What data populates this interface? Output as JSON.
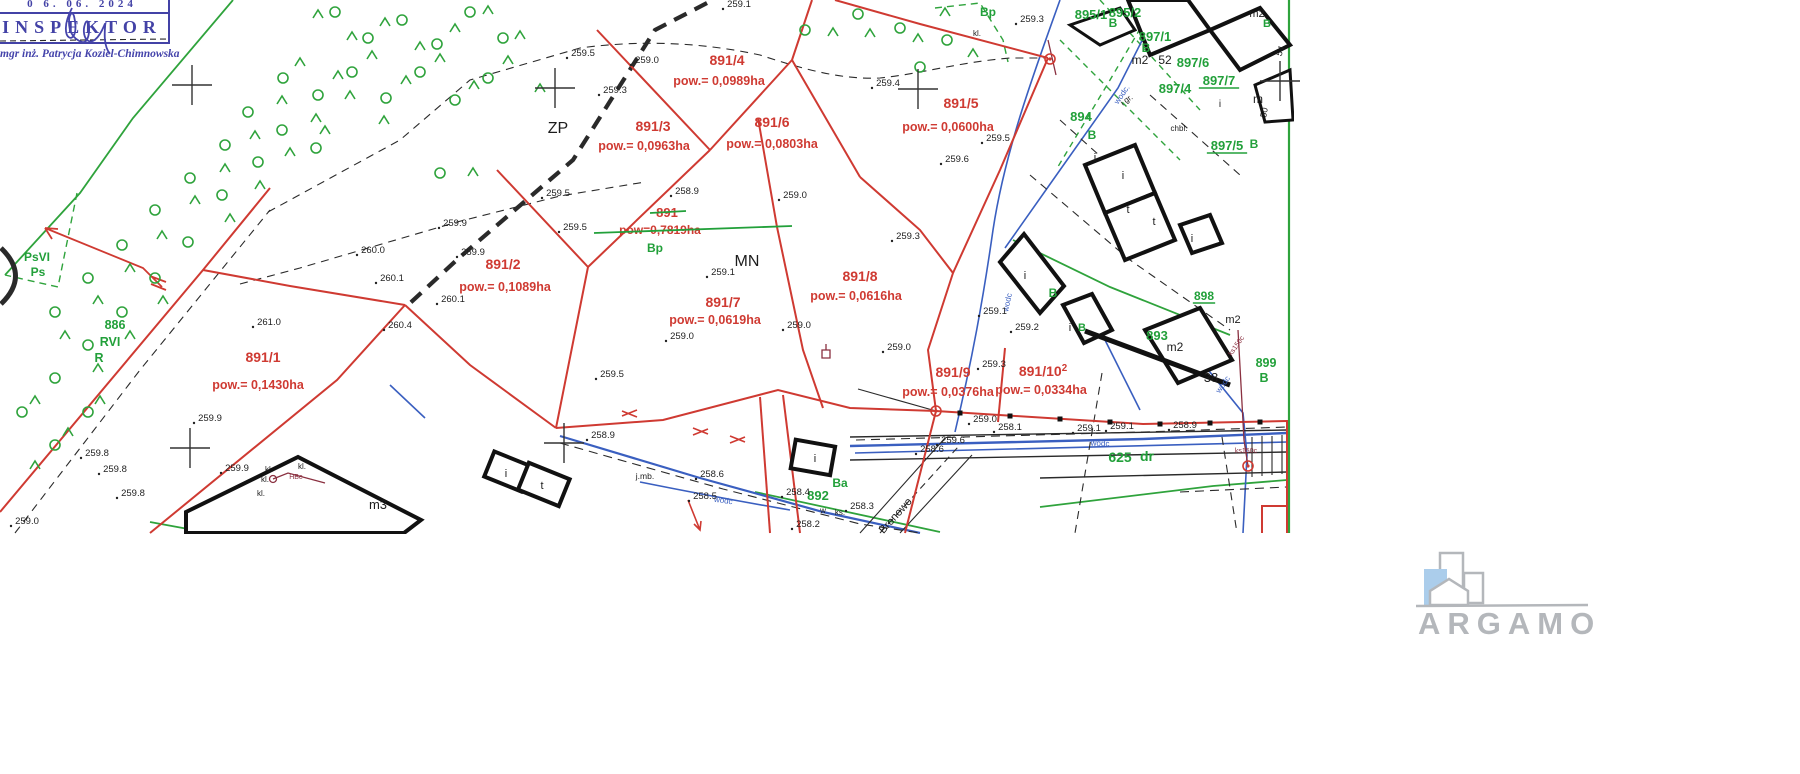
{
  "stamp": {
    "date": "0 6. 06. 2024",
    "title": "INSPEKTOR",
    "signer": "mgr inż. Patrycja Koziel-Chimnowska"
  },
  "logo": {
    "text": "ARGAMO"
  },
  "map": {
    "colors": {
      "red": "#cf3a32",
      "green": "#22a03a",
      "blue": "#3a5fc0",
      "maroon": "#8a3040",
      "black": "#1c1c1c"
    },
    "labels": [
      {
        "t": "891/1",
        "x": 263,
        "y": 362,
        "c": "red",
        "s": 14
      },
      {
        "t": "pow.= 0,1430ha",
        "x": 258,
        "y": 389,
        "c": "red",
        "s": 12.5
      },
      {
        "t": "891/2",
        "x": 503,
        "y": 269,
        "c": "red",
        "s": 14
      },
      {
        "t": "pow.= 0,1089ha",
        "x": 505,
        "y": 291,
        "c": "red",
        "s": 12.5
      },
      {
        "t": "891/3",
        "x": 653,
        "y": 131,
        "c": "red",
        "s": 14
      },
      {
        "t": "pow.= 0,0963ha",
        "x": 644,
        "y": 150,
        "c": "red",
        "s": 12.5
      },
      {
        "t": "891/4",
        "x": 727,
        "y": 65,
        "c": "red",
        "s": 14
      },
      {
        "t": "pow.= 0,0989ha",
        "x": 719,
        "y": 85,
        "c": "red",
        "s": 12.5
      },
      {
        "t": "891/5",
        "x": 961,
        "y": 108,
        "c": "red",
        "s": 14
      },
      {
        "t": "pow.= 0,0600ha",
        "x": 948,
        "y": 131,
        "c": "red",
        "s": 12.5
      },
      {
        "t": "891/6",
        "x": 772,
        "y": 127,
        "c": "red",
        "s": 14
      },
      {
        "t": "pow.= 0,0803ha",
        "x": 772,
        "y": 148,
        "c": "red",
        "s": 12.5
      },
      {
        "t": "891/7",
        "x": 723,
        "y": 307,
        "c": "red",
        "s": 14
      },
      {
        "t": "pow.= 0,0619ha",
        "x": 715,
        "y": 324,
        "c": "red",
        "s": 12.5
      },
      {
        "t": "891/8",
        "x": 860,
        "y": 281,
        "c": "red",
        "s": 14
      },
      {
        "t": "pow.= 0,0616ha",
        "x": 856,
        "y": 300,
        "c": "red",
        "s": 12.5
      },
      {
        "t": "891/9",
        "x": 953,
        "y": 377,
        "c": "red",
        "s": 14
      },
      {
        "t": "pow.= 0,0376ha",
        "x": 948,
        "y": 396,
        "c": "red",
        "s": 12.5
      },
      {
        "t": "891/10",
        "x": 1043,
        "y": 376,
        "c": "red",
        "s": 14,
        "sup": "2"
      },
      {
        "t": "pow.= 0,0334ha",
        "x": 1041,
        "y": 394,
        "c": "red",
        "s": 12.5
      },
      {
        "t": "891",
        "x": 667,
        "y": 217,
        "c": "red",
        "s": 13,
        "strike": [
          650,
          213,
          686,
          211
        ]
      },
      {
        "t": "pow=0,7819ha",
        "x": 660,
        "y": 234,
        "c": "red",
        "s": 12,
        "strike": [
          594,
          233,
          792,
          226
        ]
      },
      {
        "t": "PsVI",
        "x": 37,
        "y": 261,
        "c": "green",
        "s": 12
      },
      {
        "t": "Ps",
        "x": 38,
        "y": 276,
        "c": "green",
        "s": 12
      },
      {
        "t": "886",
        "x": 115,
        "y": 329,
        "c": "green",
        "s": 12.5
      },
      {
        "t": "RVI",
        "x": 110,
        "y": 346,
        "c": "green",
        "s": 12.5
      },
      {
        "t": "R",
        "x": 99,
        "y": 362,
        "c": "green",
        "s": 12.5
      },
      {
        "t": "Bp",
        "x": 655,
        "y": 252,
        "c": "green",
        "s": 12
      },
      {
        "t": "Bp",
        "x": 988,
        "y": 16,
        "c": "green",
        "s": 12
      },
      {
        "t": "892",
        "x": 818,
        "y": 500,
        "c": "green",
        "s": 13
      },
      {
        "t": "Ba",
        "x": 840,
        "y": 487,
        "c": "green",
        "s": 12
      },
      {
        "t": "893",
        "x": 1157,
        "y": 340,
        "c": "green",
        "s": 13
      },
      {
        "t": "894",
        "x": 1081,
        "y": 121,
        "c": "green",
        "s": 13
      },
      {
        "t": "B",
        "x": 1092,
        "y": 139,
        "c": "green",
        "s": 12
      },
      {
        "t": "895/1",
        "x": 1091,
        "y": 19,
        "c": "green",
        "s": 13
      },
      {
        "t": "895/2",
        "x": 1125,
        "y": 17,
        "c": "green",
        "s": 13
      },
      {
        "t": "B",
        "x": 1113,
        "y": 27,
        "c": "green",
        "s": 12
      },
      {
        "t": "897/1",
        "x": 1155,
        "y": 41,
        "c": "green",
        "s": 13
      },
      {
        "t": "B",
        "x": 1146,
        "y": 52,
        "c": "green",
        "s": 12
      },
      {
        "t": "897/4",
        "x": 1175,
        "y": 93,
        "c": "green",
        "s": 13
      },
      {
        "t": "897/5",
        "x": 1227,
        "y": 150,
        "c": "green",
        "s": 13,
        "u": 1
      },
      {
        "t": "B",
        "x": 1254,
        "y": 148,
        "c": "green",
        "s": 12
      },
      {
        "t": "897/6",
        "x": 1193,
        "y": 67,
        "c": "green",
        "s": 13
      },
      {
        "t": "897/7",
        "x": 1219,
        "y": 85,
        "c": "green",
        "s": 13,
        "u": 1
      },
      {
        "t": "898",
        "x": 1204,
        "y": 300,
        "c": "green",
        "s": 12,
        "u": 1
      },
      {
        "t": "B",
        "x": 1053,
        "y": 297,
        "c": "green",
        "s": 12
      },
      {
        "t": "B",
        "x": 1082,
        "y": 331,
        "c": "green",
        "s": 11
      },
      {
        "t": "899",
        "x": 1266,
        "y": 367,
        "c": "green",
        "s": 12.5
      },
      {
        "t": "B",
        "x": 1264,
        "y": 382,
        "c": "green",
        "s": 12.5
      },
      {
        "t": "B",
        "x": 1267,
        "y": 27,
        "c": "green",
        "s": 11
      },
      {
        "t": "625",
        "x": 1120,
        "y": 462,
        "c": "green",
        "s": 14
      },
      {
        "t": "dr",
        "x": 1147,
        "y": 461,
        "c": "green",
        "s": 14
      },
      {
        "t": "ZP",
        "x": 558,
        "y": 133,
        "c": "black",
        "s": 16
      },
      {
        "t": "MN",
        "x": 747,
        "y": 266,
        "c": "black",
        "s": 16
      },
      {
        "t": "m3",
        "x": 378,
        "y": 509,
        "c": "black",
        "s": 13
      },
      {
        "t": "m2",
        "x": 1140,
        "y": 64,
        "c": "black",
        "s": 12
      },
      {
        "t": "52",
        "x": 1165,
        "y": 64,
        "c": "black",
        "s": 12
      },
      {
        "t": "m2",
        "x": 1175,
        "y": 351,
        "c": "black",
        "s": 12
      },
      {
        "t": "m2",
        "x": 1233,
        "y": 323,
        "c": "black",
        "s": 11
      },
      {
        "t": "m2",
        "x": 1257,
        "y": 17,
        "c": "black",
        "s": 11
      },
      {
        "t": "m",
        "x": 1258,
        "y": 103,
        "c": "black",
        "s": 12
      },
      {
        "t": "38",
        "x": 1211,
        "y": 382,
        "c": "black",
        "s": 13
      },
      {
        "t": "i",
        "x": 506,
        "y": 477,
        "c": "black",
        "s": 11
      },
      {
        "t": "t",
        "x": 542,
        "y": 489,
        "c": "black",
        "s": 11
      },
      {
        "t": "i",
        "x": 815,
        "y": 462,
        "c": "black",
        "s": 11
      },
      {
        "t": "i",
        "x": 1025,
        "y": 279,
        "c": "black",
        "s": 11
      },
      {
        "t": "i",
        "x": 1070,
        "y": 331,
        "c": "black",
        "s": 11
      },
      {
        "t": "i",
        "x": 1095,
        "y": 161,
        "c": "black",
        "s": 11
      },
      {
        "t": "i",
        "x": 1123,
        "y": 179,
        "c": "black",
        "s": 11
      },
      {
        "t": "t",
        "x": 1128,
        "y": 213,
        "c": "black",
        "s": 11
      },
      {
        "t": "t",
        "x": 1154,
        "y": 225,
        "c": "black",
        "s": 11
      },
      {
        "t": "i",
        "x": 1192,
        "y": 242,
        "c": "black",
        "s": 11
      },
      {
        "t": "i",
        "x": 1220,
        "y": 107,
        "c": "black",
        "s": 10
      },
      {
        "t": "kl.",
        "x": 977,
        "y": 36,
        "c": "black",
        "s": 8
      },
      {
        "t": "kl.",
        "x": 302,
        "y": 469,
        "c": "black",
        "s": 8
      },
      {
        "t": "kl.",
        "x": 269,
        "y": 472,
        "c": "black",
        "s": 8
      },
      {
        "t": "kl.",
        "x": 265,
        "y": 482,
        "c": "black",
        "s": 8
      },
      {
        "t": "kl.",
        "x": 261,
        "y": 496,
        "c": "black",
        "s": 8
      },
      {
        "t": "j.mb.",
        "x": 645,
        "y": 479,
        "c": "black",
        "s": 8.5
      },
      {
        "t": "w",
        "x": 823,
        "y": 513,
        "c": "black",
        "s": 8
      },
      {
        "t": "ks.",
        "x": 840,
        "y": 515,
        "c": "black",
        "s": 8
      },
      {
        "t": "chbl.",
        "x": 1179,
        "y": 131,
        "c": "black",
        "s": 8
      },
      {
        "t": "i gr.",
        "x": 1128,
        "y": 102,
        "c": "black",
        "s": 8,
        "r": -35
      },
      {
        "t": "54",
        "x": 1283,
        "y": 52,
        "c": "black",
        "s": 9,
        "r": -70
      },
      {
        "t": "50",
        "x": 1267,
        "y": 113,
        "c": "black",
        "s": 9,
        "r": -80
      },
      {
        "t": "Bronowo",
        "x": 898,
        "y": 518,
        "c": "black",
        "s": 11,
        "r": -48
      },
      {
        "t": "wodc.",
        "x": 1124,
        "y": 96,
        "c": "blue",
        "s": 8,
        "r": -55
      },
      {
        "t": "wodc",
        "x": 1010,
        "y": 303,
        "c": "blue",
        "s": 8,
        "r": -78
      },
      {
        "t": "wodc",
        "x": 723,
        "y": 503,
        "c": "blue",
        "s": 8,
        "r": 8
      },
      {
        "t": "wodc",
        "x": 1100,
        "y": 446,
        "c": "blue",
        "s": 8,
        "r": 2
      },
      {
        "t": "wodc",
        "x": 1225,
        "y": 386,
        "c": "blue",
        "s": 8,
        "r": -55
      },
      {
        "t": "ks150c",
        "x": 1238,
        "y": 347,
        "c": "maroon",
        "s": 7,
        "r": -55
      },
      {
        "t": "ks150c",
        "x": 1246,
        "y": 453,
        "c": "maroon",
        "s": 7
      },
      {
        "t": "HBe",
        "x": 296,
        "y": 479,
        "c": "maroon",
        "s": 7
      }
    ],
    "elevations": [
      {
        "t": "259.1",
        "x": 739,
        "y": 7
      },
      {
        "t": "259.3",
        "x": 1032,
        "y": 22
      },
      {
        "t": "259.5",
        "x": 583,
        "y": 56
      },
      {
        "t": "259.0",
        "x": 647,
        "y": 63
      },
      {
        "t": "259.4",
        "x": 888,
        "y": 86
      },
      {
        "t": "259.3",
        "x": 615,
        "y": 93
      },
      {
        "t": "259.5",
        "x": 998,
        "y": 141
      },
      {
        "t": "259.6",
        "x": 957,
        "y": 162
      },
      {
        "t": "259.5",
        "x": 558,
        "y": 196
      },
      {
        "t": "258.9",
        "x": 687,
        "y": 194
      },
      {
        "t": "259.0",
        "x": 795,
        "y": 198
      },
      {
        "t": "259.9",
        "x": 455,
        "y": 226
      },
      {
        "t": "259.5",
        "x": 575,
        "y": 230
      },
      {
        "t": "259.3",
        "x": 908,
        "y": 239
      },
      {
        "t": "259.9",
        "x": 473,
        "y": 255
      },
      {
        "t": "260.0",
        "x": 373,
        "y": 253
      },
      {
        "t": "260.1",
        "x": 392,
        "y": 281
      },
      {
        "t": "260.1",
        "x": 453,
        "y": 302
      },
      {
        "t": "261.0",
        "x": 269,
        "y": 325
      },
      {
        "t": "260.4",
        "x": 400,
        "y": 328
      },
      {
        "t": "259.1",
        "x": 723,
        "y": 275
      },
      {
        "t": "259.0",
        "x": 682,
        "y": 339
      },
      {
        "t": "259.0",
        "x": 799,
        "y": 328
      },
      {
        "t": "259.0",
        "x": 899,
        "y": 350
      },
      {
        "t": "259.1",
        "x": 995,
        "y": 314
      },
      {
        "t": "259.2",
        "x": 1027,
        "y": 330
      },
      {
        "t": "259.3",
        "x": 994,
        "y": 367
      },
      {
        "t": "259.0",
        "x": 985,
        "y": 422
      },
      {
        "t": "258.1",
        "x": 1010,
        "y": 430
      },
      {
        "t": "259.1",
        "x": 1089,
        "y": 431
      },
      {
        "t": "259.1",
        "x": 1122,
        "y": 429
      },
      {
        "t": "258.9",
        "x": 1185,
        "y": 428
      },
      {
        "t": "259.6",
        "x": 953,
        "y": 443
      },
      {
        "t": "258.6",
        "x": 932,
        "y": 452
      },
      {
        "t": "259.5",
        "x": 612,
        "y": 377
      },
      {
        "t": "258.9",
        "x": 603,
        "y": 438
      },
      {
        "t": "258.6",
        "x": 712,
        "y": 477
      },
      {
        "t": "258.5",
        "x": 705,
        "y": 499
      },
      {
        "t": "258.4",
        "x": 798,
        "y": 495
      },
      {
        "t": "258.3",
        "x": 862,
        "y": 509
      },
      {
        "t": "258.2",
        "x": 808,
        "y": 527
      },
      {
        "t": "259.9",
        "x": 210,
        "y": 421
      },
      {
        "t": "259.8",
        "x": 97,
        "y": 456
      },
      {
        "t": "259.8",
        "x": 115,
        "y": 472
      },
      {
        "t": "259.8",
        "x": 133,
        "y": 496
      },
      {
        "t": "259.0",
        "x": 27,
        "y": 524
      },
      {
        "t": "259.9",
        "x": 237,
        "y": 471
      }
    ],
    "symbols": {
      "carets": [
        [
          318,
          14
        ],
        [
          352,
          36
        ],
        [
          385,
          22
        ],
        [
          420,
          46
        ],
        [
          455,
          28
        ],
        [
          488,
          10
        ],
        [
          520,
          35
        ],
        [
          300,
          62
        ],
        [
          338,
          75
        ],
        [
          372,
          55
        ],
        [
          406,
          80
        ],
        [
          440,
          58
        ],
        [
          474,
          85
        ],
        [
          508,
          60
        ],
        [
          540,
          88
        ],
        [
          282,
          100
        ],
        [
          316,
          118
        ],
        [
          350,
          95
        ],
        [
          384,
          120
        ],
        [
          255,
          135
        ],
        [
          290,
          152
        ],
        [
          325,
          130
        ],
        [
          225,
          168
        ],
        [
          260,
          185
        ],
        [
          195,
          200
        ],
        [
          230,
          218
        ],
        [
          162,
          235
        ],
        [
          130,
          268
        ],
        [
          98,
          300
        ],
        [
          163,
          300
        ],
        [
          65,
          335
        ],
        [
          130,
          335
        ],
        [
          98,
          368
        ],
        [
          35,
          400
        ],
        [
          100,
          400
        ],
        [
          68,
          432
        ],
        [
          35,
          465
        ],
        [
          473,
          172
        ],
        [
          833,
          32
        ],
        [
          870,
          33
        ],
        [
          918,
          38
        ],
        [
          973,
          53
        ],
        [
          945,
          12
        ]
      ],
      "circles": [
        [
          335,
          12
        ],
        [
          368,
          38
        ],
        [
          402,
          20
        ],
        [
          437,
          44
        ],
        [
          470,
          12
        ],
        [
          503,
          38
        ],
        [
          283,
          78
        ],
        [
          318,
          95
        ],
        [
          352,
          72
        ],
        [
          386,
          98
        ],
        [
          420,
          72
        ],
        [
          455,
          100
        ],
        [
          488,
          78
        ],
        [
          248,
          112
        ],
        [
          282,
          130
        ],
        [
          316,
          148
        ],
        [
          225,
          145
        ],
        [
          190,
          178
        ],
        [
          258,
          162
        ],
        [
          155,
          210
        ],
        [
          222,
          195
        ],
        [
          122,
          245
        ],
        [
          188,
          242
        ],
        [
          88,
          278
        ],
        [
          155,
          278
        ],
        [
          55,
          312
        ],
        [
          122,
          312
        ],
        [
          88,
          345
        ],
        [
          55,
          378
        ],
        [
          22,
          412
        ],
        [
          88,
          412
        ],
        [
          55,
          445
        ],
        [
          440,
          173
        ],
        [
          805,
          30
        ],
        [
          858,
          14
        ],
        [
          900,
          28
        ],
        [
          947,
          40
        ],
        [
          920,
          67
        ]
      ]
    },
    "crosses": [
      [
        192,
        85
      ],
      [
        555,
        88
      ],
      [
        918,
        89
      ],
      [
        190,
        448
      ],
      [
        564,
        443
      ],
      [
        1280,
        81
      ]
    ],
    "survey_points": [
      [
        1050,
        59
      ],
      [
        936,
        411
      ],
      [
        1248,
        466
      ]
    ],
    "road_dots": [
      [
        960,
        413
      ],
      [
        1010,
        416
      ],
      [
        1060,
        419
      ],
      [
        1110,
        422
      ],
      [
        1160,
        424
      ],
      [
        1210,
        423
      ],
      [
        1260,
        422
      ]
    ]
  }
}
